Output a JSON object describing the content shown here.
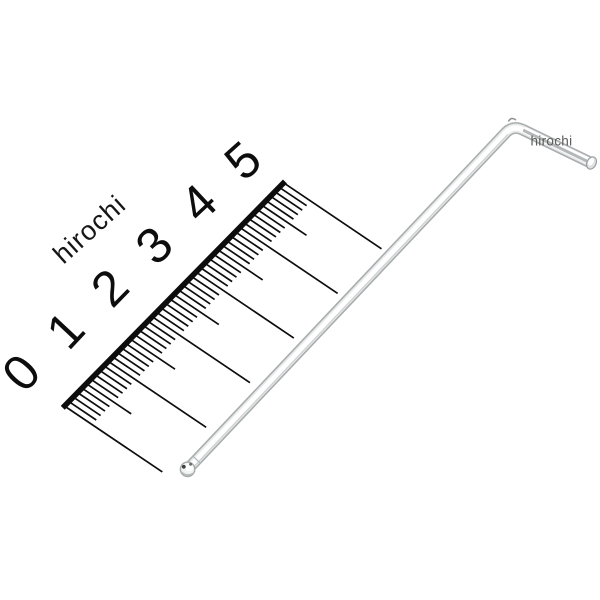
{
  "scene": {
    "width": 600,
    "height": 600,
    "background": "#ffffff",
    "subject": "ball-end-hex-key-with-ruler-product-photo"
  },
  "watermarks": {
    "rotated": {
      "text": "hirochi",
      "x": 95.5,
      "y": 236,
      "rotation": -42,
      "size": 27,
      "letter_spacing": 1,
      "color": "#161616",
      "anchor": "middle"
    },
    "flat": {
      "text": "hirochi",
      "x": 530.5,
      "y": 145.5,
      "rotation": 0,
      "size": 13.5,
      "letter_spacing": 0.3,
      "color": "#5a5a5a",
      "anchor": "start"
    }
  },
  "ruler": {
    "numbers": [
      "0",
      "1",
      "2",
      "3",
      "4",
      "5"
    ],
    "ink": "#0d0d0d",
    "origin": [
      64.5,
      406
    ],
    "axis_dir": [
      0.7006,
      -0.7135
    ],
    "tick_dir": [
      0.829,
      0.559
    ],
    "mm_px": 6.256,
    "mm_count": 50,
    "edge": {
      "from_mm": -0.4,
      "to_mm": 50.3,
      "width": 5.6
    },
    "tick_len": {
      "small": 33,
      "medium": 54,
      "major": 118
    },
    "tick_width": 1.7,
    "number_style": {
      "size": 50,
      "offset": [
        -44,
        -34
      ],
      "offset_step": [
        0.5,
        2.2
      ],
      "rotation_start": -48,
      "rotation_step": 1.2
    }
  },
  "wrench": {
    "kind": "ball-end-hex-key",
    "ball_center": [
      187.6,
      469.3
    ],
    "ball_radius": 7.2,
    "elbow": [
      513,
      125
    ],
    "elbow_shoulder": 11,
    "tip": [
      591.5,
      163
    ],
    "tip_rx": 4.6,
    "tip_ry": 6.4,
    "shaft_width_outer": 11.8,
    "shaft_width_mid": 8.6,
    "shaft_width_core": 5.2,
    "colors": {
      "edge": "#a9adad",
      "mid": "#e9ebeb",
      "core": "#ffffff",
      "shade": "#b4b8b8",
      "light_shade": "#cfd3d3",
      "rim": "#9aa0a0",
      "face": "#dfe1e1",
      "dark_arc": "#8e9292",
      "spot_dark": "#3f3f3f",
      "spot_mid": "#6e6e6e",
      "crescent": "#b5b9b9",
      "ball_fill": "#f2f3f3",
      "ball_rim": "#a5a9a9"
    }
  }
}
